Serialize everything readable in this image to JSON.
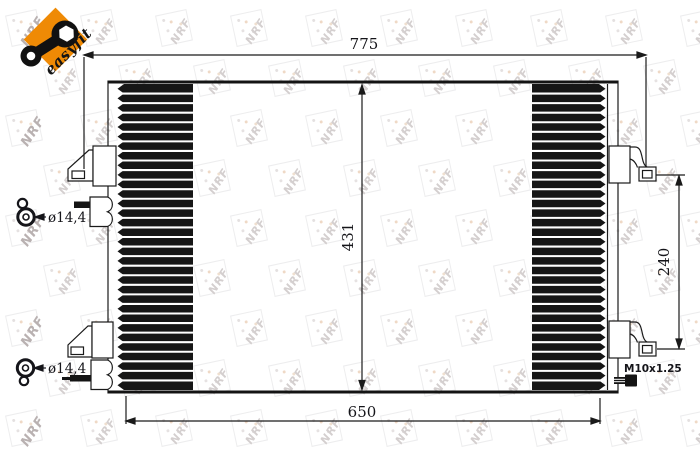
{
  "logo": {
    "brand": "easyfit",
    "badge_color": "#ef8a05"
  },
  "watermark": {
    "text": "NRF"
  },
  "drawing": {
    "line_color": "#1a1a1a",
    "dims": {
      "overall_width": "775",
      "core_height": "431",
      "core_width": "650",
      "port_spacing": "240",
      "port_top": "ø14,4",
      "port_bottom": "ø14,4",
      "thread": "M10x1.25"
    }
  }
}
